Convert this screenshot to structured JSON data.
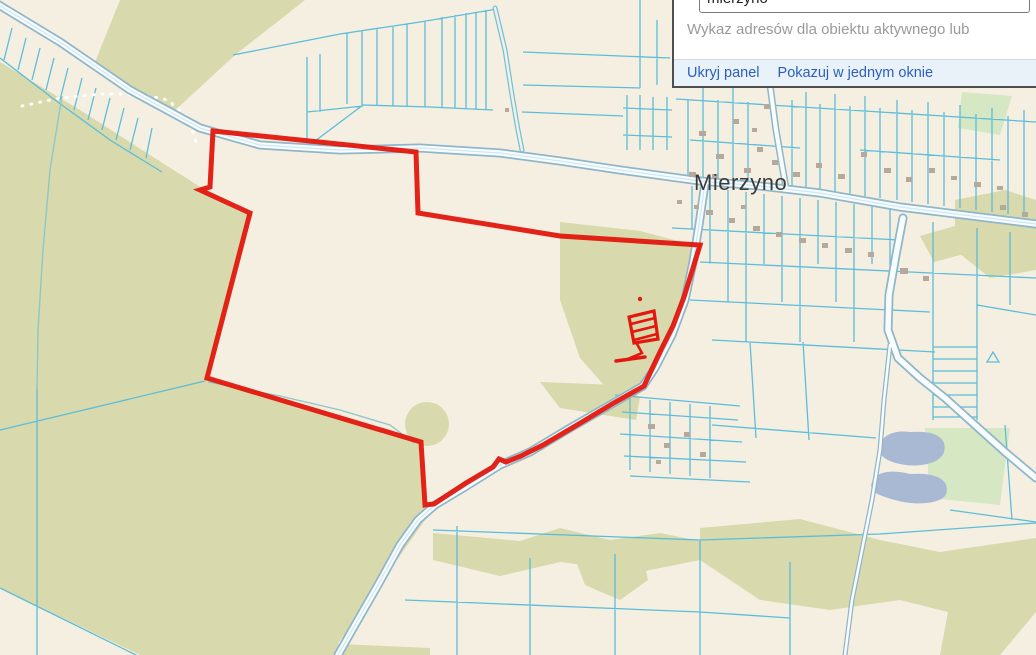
{
  "panel": {
    "search_input": {
      "value": "mierzyno",
      "placeholder": ""
    },
    "helper_text": "Wykaz adresów dla obiektu aktywnego lub",
    "links": [
      {
        "label": "Ukryj panel"
      },
      {
        "label": "Pokazuj w jednym oknie"
      }
    ]
  },
  "map": {
    "place_label": "Mierzyno",
    "selection": {
      "type": "red-boundary-highlight-with-hatched-parcel"
    },
    "colors": {
      "background": "#f5efe2",
      "forest": "#d8d9ac",
      "meadow": "#d5e7c3",
      "water": "#a9b9d3",
      "parcel_line": "#5bbdd9",
      "road_casing": "#8fb6c9",
      "road_fill": "#f8fcfe",
      "selection_red": "#e3170d",
      "building": "#b6a89b",
      "label_text": "#3b3b3b"
    }
  }
}
